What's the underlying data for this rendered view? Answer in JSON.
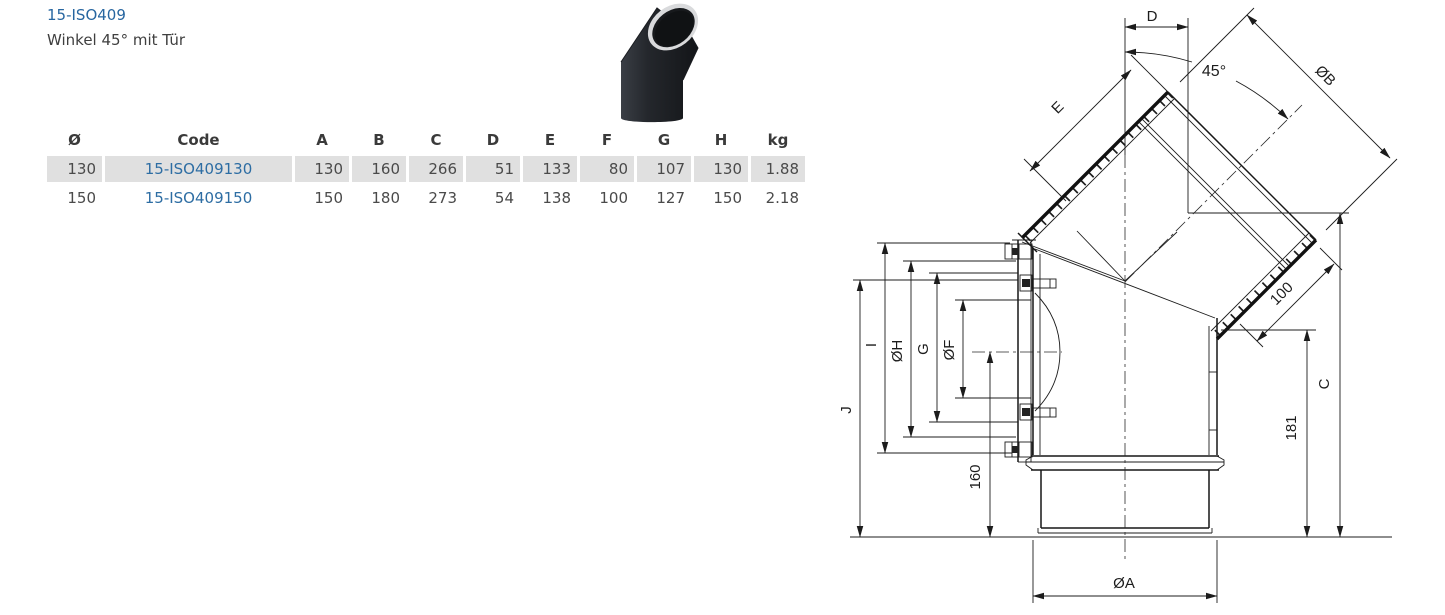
{
  "header": {
    "code_link": "15-ISO409",
    "subtitle": "Winkel 45° mit Tür"
  },
  "table": {
    "columns": [
      "Ø",
      "Code",
      "A",
      "B",
      "C",
      "D",
      "E",
      "F",
      "G",
      "H",
      "kg"
    ],
    "rows": [
      {
        "cells": [
          "130",
          "15-ISO409130",
          "130",
          "160",
          "266",
          "51",
          "133",
          "80",
          "107",
          "130",
          "1.88"
        ],
        "highlighted": true
      },
      {
        "cells": [
          "150",
          "15-ISO409150",
          "150",
          "180",
          "273",
          "54",
          "138",
          "100",
          "127",
          "150",
          "2.18"
        ],
        "highlighted": false
      }
    ],
    "link_color": "#2d6da3",
    "highlight_bg": "#e0e0e0"
  },
  "drawing": {
    "labels": {
      "d": "D",
      "angle_45": "45°",
      "dia_b": "ØB",
      "e": "E",
      "j": "J",
      "i": "I",
      "dia_h": "ØH",
      "g": "G",
      "dia_f": "ØF",
      "len_160": "160",
      "len_100": "100",
      "len_181": "181",
      "c": "C",
      "dia_a": "ØA"
    },
    "line_color": "#1c1c1c"
  }
}
